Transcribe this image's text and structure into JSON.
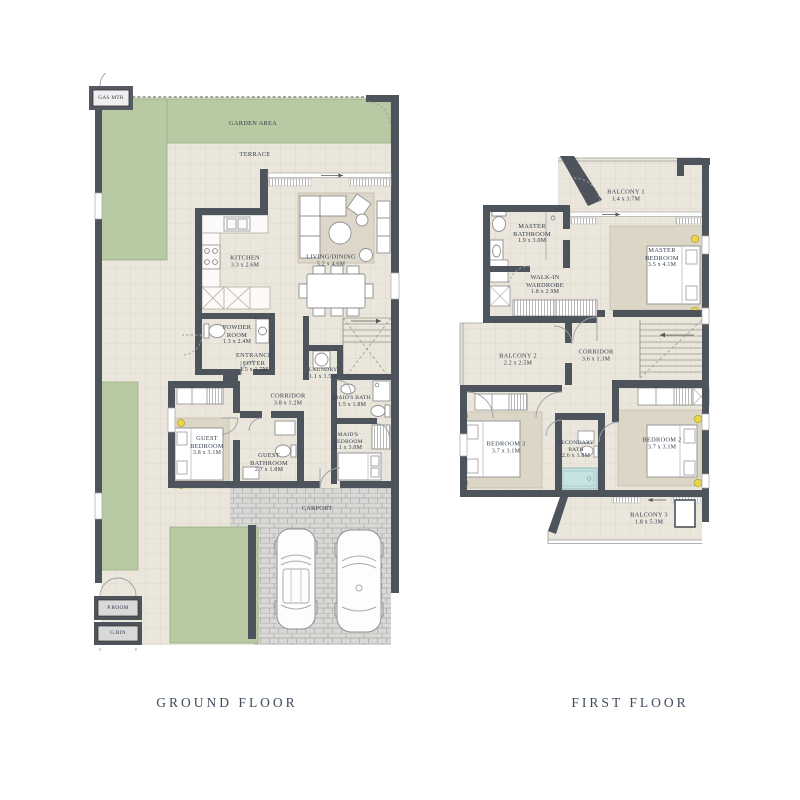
{
  "title": "Townhouse Floor Plans",
  "captions": {
    "ground": "GROUND FLOOR",
    "first": "FIRST FLOOR"
  },
  "colors": {
    "wall": "#4e545c",
    "floor": "#eae6db",
    "grid_line": "#dcd5c6",
    "garden": "#b8caa4",
    "paving": "#d8d8d6",
    "carpet": "#dcd6c7",
    "bathtub": "#c6e3e2",
    "lamp": "#e8d44d",
    "text": "#333f4e"
  },
  "ground_floor": {
    "caption": "GROUND FLOOR",
    "rooms": [
      {
        "name": "GARDEN AREA",
        "dims": ""
      },
      {
        "name": "TERRACE",
        "dims": ""
      },
      {
        "name": "KITCHEN",
        "dims": "3.3 x 2.6M"
      },
      {
        "name": "LIVING/DINING",
        "dims": "5.2 x 4.6M"
      },
      {
        "name": "POWDER ROOM",
        "dims": "1.3 x 2.4M"
      },
      {
        "name": "ENTRANCE FOYER",
        "dims": "1.5 x 1.7M"
      },
      {
        "name": "LAUNDRY",
        "dims": "1.1 x 1.5M"
      },
      {
        "name": "CORRIDOR",
        "dims": "3.8 x 1.2M"
      },
      {
        "name": "MAID'S BATH",
        "dims": "1.5 x 1.8M"
      },
      {
        "name": "GUEST BEDROOM",
        "dims": "3.8 x 3.1M"
      },
      {
        "name": "GUEST BATHROOM",
        "dims": "2.7 x 1.8M"
      },
      {
        "name": "MAID'S BEDROOM",
        "dims": "2.1 x 3.0M"
      },
      {
        "name": "CARPORT",
        "dims": ""
      },
      {
        "name": "GAS MTR",
        "dims": ""
      },
      {
        "name": "P.ROOM",
        "dims": ""
      },
      {
        "name": "G.BIN",
        "dims": ""
      }
    ]
  },
  "first_floor": {
    "caption": "FIRST FLOOR",
    "rooms": [
      {
        "name": "BALCONY 1",
        "dims": "1.4 x 3.7M"
      },
      {
        "name": "MASTER BATHROOM",
        "dims": "1.9 x 3.0M"
      },
      {
        "name": "WALK-IN WARDROBE",
        "dims": "1.8 x 2.9M"
      },
      {
        "name": "MASTER BEDROOM",
        "dims": "3.5 x 4.1M"
      },
      {
        "name": "BALCONY 2",
        "dims": "2.2 x 2.5M"
      },
      {
        "name": "CORRIDOR",
        "dims": "3.6 x 1.3M"
      },
      {
        "name": "BEDROOM 3",
        "dims": "3.7 x 3.1M"
      },
      {
        "name": "SECONDARY BATH",
        "dims": "2.6 x 1.8M"
      },
      {
        "name": "BEDROOM 2",
        "dims": "3.7 x 3.1M"
      },
      {
        "name": "BALCONY 3",
        "dims": "1.8 x 5.3M"
      }
    ]
  }
}
